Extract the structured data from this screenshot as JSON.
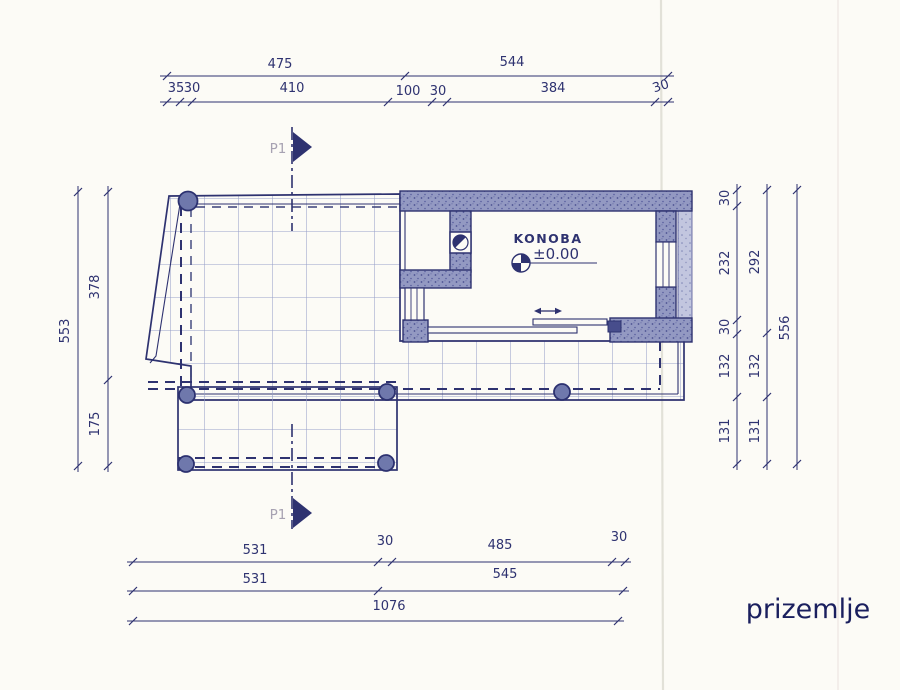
{
  "title": {
    "text": "prizemlje"
  },
  "plan": {
    "room": {
      "name": "KONOBA",
      "level": "±0.00"
    },
    "section_marks": {
      "top": "P1",
      "bottom": "P1"
    }
  },
  "dimensions": {
    "top_row1": [
      "475",
      "544"
    ],
    "top_row2": [
      "35",
      "30",
      "410",
      "100",
      "30",
      "384",
      "30"
    ],
    "left_outer": [
      "553"
    ],
    "left_inner": [
      "378",
      "175"
    ],
    "right_inner": [
      "30",
      "232",
      "30",
      "132",
      "131"
    ],
    "right_middle": [
      "292",
      "132",
      "131"
    ],
    "right_outer": [
      "556"
    ],
    "bottom_row1": [
      "531",
      "30",
      "485",
      "30"
    ],
    "bottom_row2": [
      "531",
      "545"
    ],
    "bottom_row3": [
      "1076"
    ]
  },
  "icons": {
    "section_cut": "filled-right-triangle",
    "level_marker": "quadrant-circle",
    "floor_drain": "circle-in-square",
    "door_slide": "double-arrow"
  },
  "colors": {
    "ink": "#2e3270",
    "wall_fill": "#9399c2",
    "wall_fill_light": "#c2c6df",
    "tile_line": "#99a1c9",
    "column_fill": "#6f78ac",
    "paper": "#fcfbf6",
    "fold_line": "#e2e1d8",
    "section_label": "#a7a2b2",
    "title_text": "#1a1f5e"
  }
}
